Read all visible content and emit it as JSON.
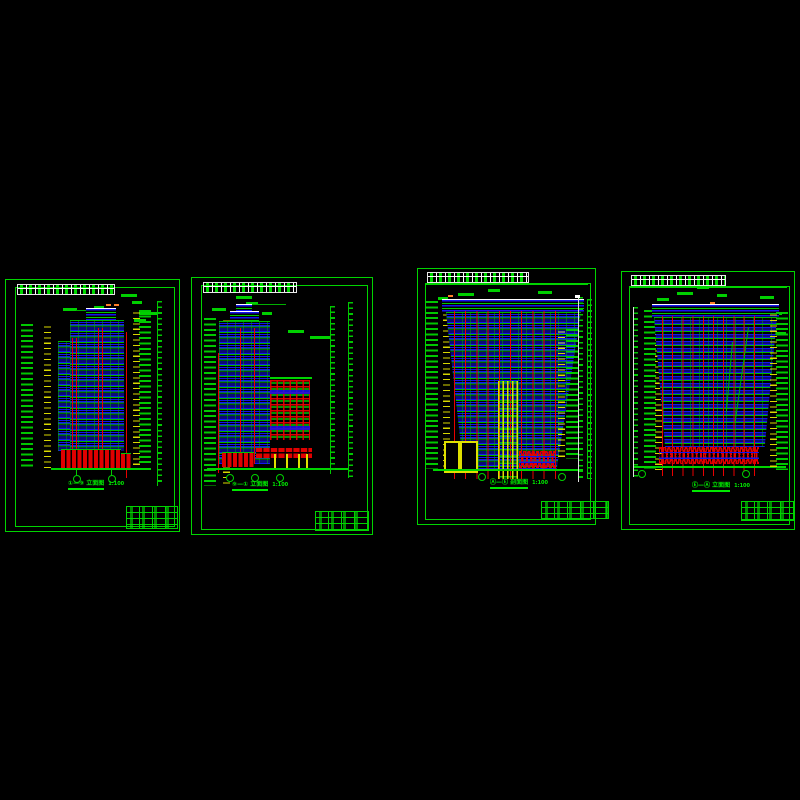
{
  "app": {
    "type": "cad-drawing-model-space",
    "background": "#000000"
  },
  "colors": {
    "frame_green": "#00d400",
    "annotation_green": "#00e800",
    "window_blue": "#1414f0",
    "structure_red": "#e80000",
    "level_yellow": "#e0e000",
    "accent_orange": "#ff7f27",
    "table_white": "#ffffff"
  },
  "sheets": [
    {
      "id": "sheet-1",
      "drawing": "building-elevation-front",
      "title": "①—⑨ 立面图",
      "scale": "1:100"
    },
    {
      "id": "sheet-2",
      "drawing": "building-elevation-side",
      "title": "⑨—① 立面图",
      "scale": "1:100"
    },
    {
      "id": "sheet-3",
      "drawing": "building-section",
      "title": "Ⓐ—Ⓔ 剖面图",
      "scale": "1:100"
    },
    {
      "id": "sheet-4",
      "drawing": "building-elevation-rear",
      "title": "Ⓔ—Ⓐ 立面图",
      "scale": "1:100"
    }
  ]
}
